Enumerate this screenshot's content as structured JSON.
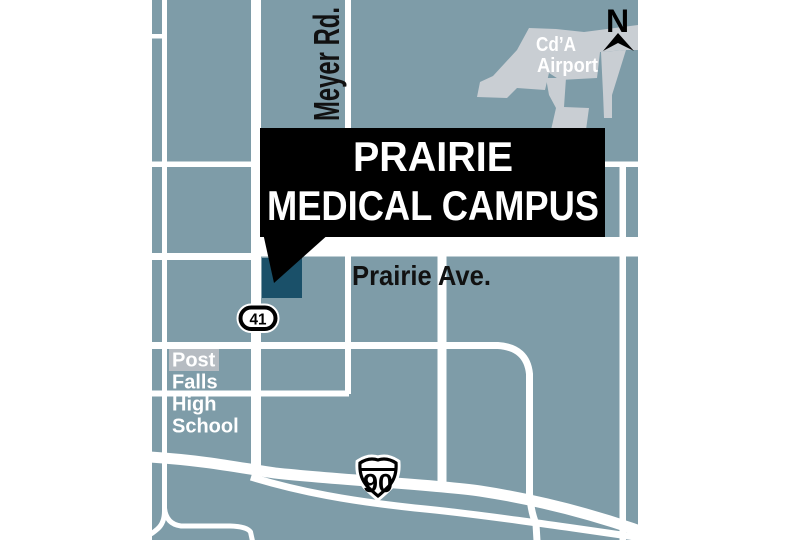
{
  "map_title": "Prairie Medical Campus locator map",
  "colors": {
    "page_bg": "#FFFFFF",
    "land": "#7E9CA8",
    "road": "#FFFFFF",
    "airport_area": "#C9CED3",
    "campus_marker": "#1A5069",
    "callout_bg": "#000000",
    "callout_text": "#FFFFFF",
    "dark_label": "#111111",
    "school_label_bg": "#B6BCC2",
    "school_label_text": "#FFFFFF"
  },
  "callout": {
    "line1": "PRAIRIE",
    "line2": "MEDICAL CAMPUS"
  },
  "labels": {
    "meyer_rd": "Meyer Rd.",
    "prairie_ave": "Prairie Ave.",
    "airport_line1": "Cd’A",
    "airport_line2": "Airport",
    "school_line1": "Post",
    "school_line2": "Falls",
    "school_line3": "High",
    "school_line4": "School",
    "compass_north": "N"
  },
  "shields": {
    "state_route": "41",
    "interstate": "90"
  }
}
